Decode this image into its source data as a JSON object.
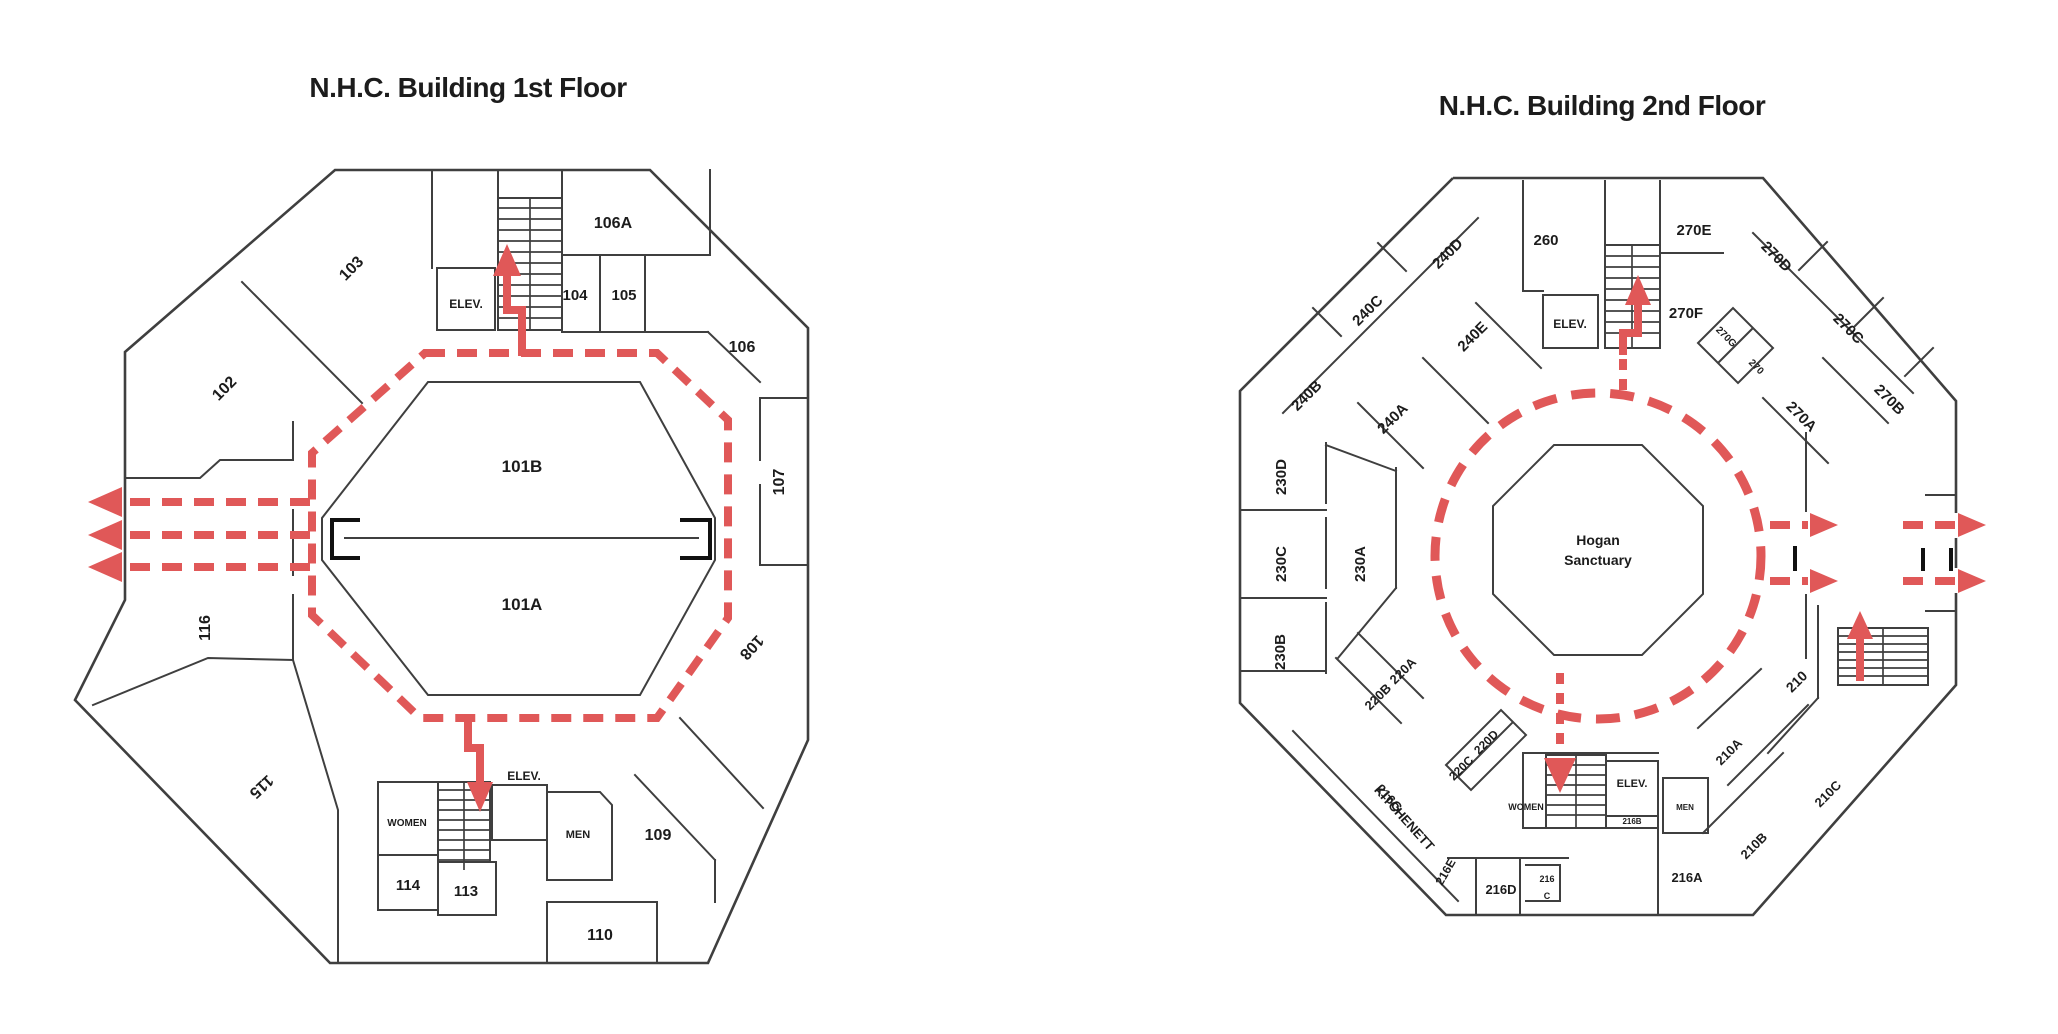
{
  "colors": {
    "route": "#e05858",
    "wall": "#3f3f3f",
    "text": "#1c1c1c"
  },
  "floor1": {
    "title": "N.H.C. Building 1st Floor",
    "rooms": {
      "r101b": "101B",
      "r101a": "101A",
      "r102": "102",
      "r103": "103",
      "r104": "104",
      "r105": "105",
      "r106": "106",
      "r106a": "106A",
      "r107": "107",
      "r108": "108",
      "r109": "109",
      "r110": "110",
      "r113": "113",
      "r114": "114",
      "r115": "115",
      "r116": "116",
      "elev_top": "ELEV.",
      "elev_bottom": "ELEV.",
      "women": "WOMEN",
      "men": "MEN"
    }
  },
  "floor2": {
    "title": "N.H.C. Building 2nd Floor",
    "center": {
      "line1": "Hogan",
      "line2": "Sanctuary"
    },
    "rooms": {
      "r210": "210",
      "r210a": "210A",
      "r210b": "210B",
      "r210c": "210C",
      "r216a": "216A",
      "r216b": "216B",
      "r216c_1": "216",
      "r216c_2": "C",
      "r216d": "216D",
      "r216e": "216E",
      "r216g": "216G",
      "kitchenett": "KITCHENETT",
      "r220a": "220A",
      "r220b": "220B",
      "r220c": "220C",
      "r220d": "220D",
      "r230a": "230A",
      "r230b": "230B",
      "r230c": "230C",
      "r230d": "230D",
      "r240a": "240A",
      "r240b": "240B",
      "r240c": "240C",
      "r240d": "240D",
      "r240e": "240E",
      "r260": "260",
      "r270": "270",
      "r270a": "270A",
      "r270b": "270B",
      "r270c": "270C",
      "r270d": "270D",
      "r270e": "270E",
      "r270f": "270F",
      "r270g": "270G",
      "elev_top": "ELEV.",
      "elev_bottom": "ELEV.",
      "women": "WOMEN",
      "men": "MEN"
    }
  }
}
